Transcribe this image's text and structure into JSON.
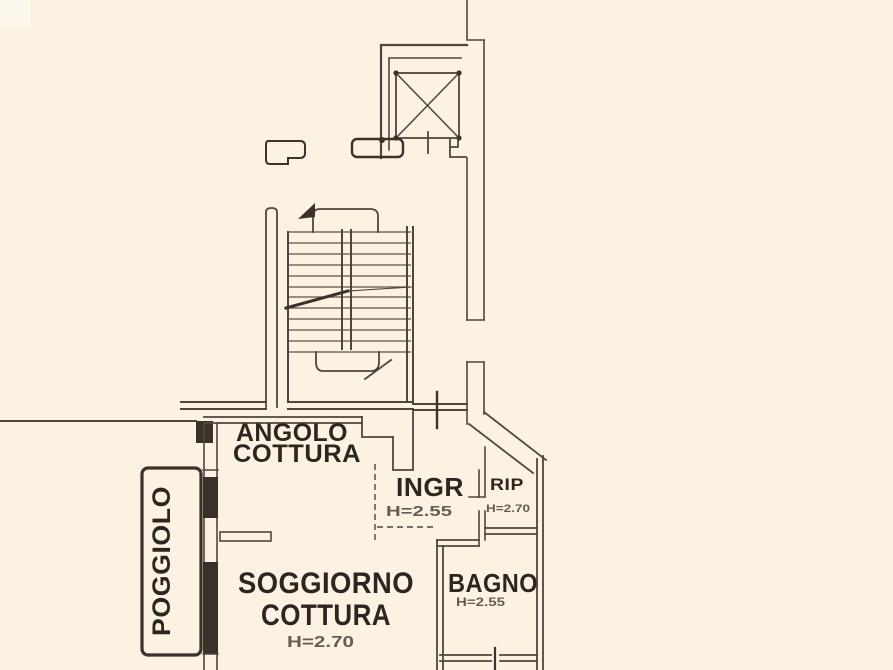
{
  "plan": {
    "rooms": {
      "angolo_cottura": {
        "line1": "ANGOLO",
        "line2": "COTTURA"
      },
      "ingresso": {
        "name": "INGR",
        "height": "H=2.55"
      },
      "ripostiglio": {
        "name": "RIP",
        "height": "H=2.70"
      },
      "soggiorno": {
        "line1": "SOGGIORNO",
        "line2": "COTTURA",
        "height": "H=2.70"
      },
      "bagno": {
        "name": "BAGNO",
        "height": "H=2.55"
      },
      "poggiolo": {
        "name": "POGGIOLO"
      }
    },
    "features": {
      "elevator": "elevator-shaft",
      "stairs": "staircase",
      "balcony": "poggiolo-balcony"
    },
    "colors": {
      "background": "#fbf2e2",
      "wall": "#4e463c",
      "wall_dark": "#38322a",
      "text": "#2c2620"
    }
  }
}
